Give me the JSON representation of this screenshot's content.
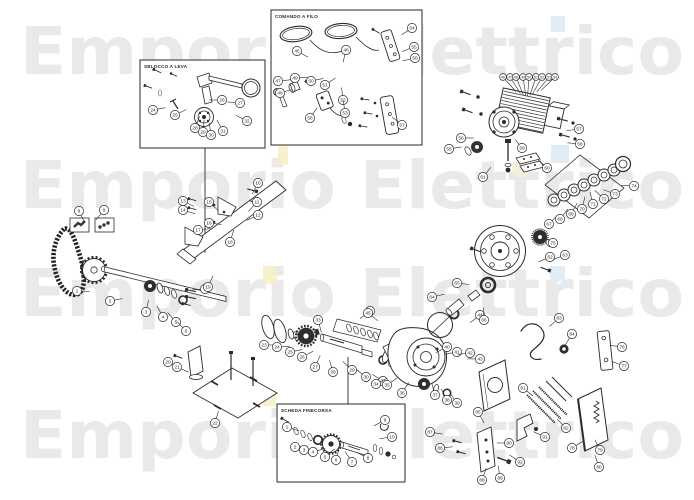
{
  "page": {
    "background": "#ffffff",
    "line_color": "#2a2a2a",
    "dark_fill": "#2e2e2e"
  },
  "watermark": {
    "text": "Emporio Elettrico",
    "color": "#e9e9e9"
  },
  "accents": {
    "yellow": "#f6eec6",
    "blue": "#dceaf5"
  },
  "insets": {
    "sblocco": {
      "label": "SBLOCCO A LEVA"
    },
    "comando": {
      "label": "COMANDO A FILO"
    },
    "scheda": {
      "label": "SCHEDA FINECORSA"
    }
  },
  "callouts": {
    "radius": 4.6,
    "font_size": 4.8,
    "clusters": [
      {
        "name": "chain-shaft",
        "a": [
          150,
          293
        ],
        "items": [
          {
            "n": 1,
            "x": 77,
            "y": 291
          },
          {
            "n": 2,
            "x": 110,
            "y": 301
          },
          {
            "n": 3,
            "x": 146,
            "y": 312
          },
          {
            "n": 4,
            "x": 163,
            "y": 317
          },
          {
            "n": 5,
            "x": 176,
            "y": 322
          },
          {
            "n": 6,
            "x": 186,
            "y": 331
          },
          {
            "n": 7,
            "x": 205,
            "y": 289
          }
        ]
      },
      {
        "name": "fastener-kits",
        "a": [
          88,
          230
        ],
        "items": [
          {
            "n": 8,
            "x": 79,
            "y": 211
          },
          {
            "n": 9,
            "x": 104,
            "y": 210
          }
        ]
      },
      {
        "name": "guide-rail",
        "a": [
          235,
          226
        ],
        "items": [
          {
            "n": 10,
            "x": 258,
            "y": 183
          },
          {
            "n": 11,
            "x": 257,
            "y": 202
          },
          {
            "n": 12,
            "x": 258,
            "y": 215
          },
          {
            "n": 13,
            "x": 183,
            "y": 201
          },
          {
            "n": 14,
            "x": 183,
            "y": 210
          },
          {
            "n": 15,
            "x": 209,
            "y": 202
          },
          {
            "n": 16,
            "x": 209,
            "y": 223
          },
          {
            "n": 17,
            "x": 198,
            "y": 230
          },
          {
            "n": 18,
            "x": 230,
            "y": 242
          },
          {
            "n": 19,
            "x": 208,
            "y": 287
          }
        ]
      },
      {
        "name": "base-plate",
        "a": [
          225,
          388
        ],
        "items": [
          {
            "n": 20,
            "x": 168,
            "y": 362
          },
          {
            "n": 21,
            "x": 177,
            "y": 367
          },
          {
            "n": 22,
            "x": 215,
            "y": 423
          }
        ]
      },
      {
        "name": "output-shaft",
        "a": [
          325,
          345
        ],
        "items": [
          {
            "n": 23,
            "x": 264,
            "y": 345
          },
          {
            "n": 24,
            "x": 277,
            "y": 347
          },
          {
            "n": 25,
            "x": 290,
            "y": 352
          },
          {
            "n": 26,
            "x": 302,
            "y": 357
          },
          {
            "n": 27,
            "x": 315,
            "y": 367
          },
          {
            "n": 28,
            "x": 333,
            "y": 372
          },
          {
            "n": 29,
            "x": 352,
            "y": 370
          },
          {
            "n": 30,
            "x": 366,
            "y": 377
          },
          {
            "n": 31,
            "x": 383,
            "y": 381
          },
          {
            "n": 32,
            "x": 370,
            "y": 311
          },
          {
            "n": 33,
            "x": 318,
            "y": 320
          }
        ]
      },
      {
        "name": "gearbox",
        "a": [
          425,
          358
        ],
        "items": [
          {
            "n": 34,
            "x": 376,
            "y": 384
          },
          {
            "n": 35,
            "x": 387,
            "y": 385
          },
          {
            "n": 36,
            "x": 402,
            "y": 393
          },
          {
            "n": 37,
            "x": 435,
            "y": 395
          },
          {
            "n": 38,
            "x": 447,
            "y": 400
          },
          {
            "n": 39,
            "x": 457,
            "y": 403
          },
          {
            "n": 40,
            "x": 447,
            "y": 347
          },
          {
            "n": 41,
            "x": 457,
            "y": 352
          },
          {
            "n": 42,
            "x": 470,
            "y": 353
          },
          {
            "n": 43,
            "x": 480,
            "y": 359
          },
          {
            "n": 44,
            "x": 480,
            "y": 315
          },
          {
            "n": 45,
            "x": 368,
            "y": 313
          }
        ]
      },
      {
        "name": "motor-row",
        "a": [
          527,
          104
        ],
        "r": 3.4,
        "fs": 3.6,
        "len": 16,
        "items": [
          {
            "n": 46,
            "x": 503,
            "y": 77
          },
          {
            "n": 47,
            "x": 510,
            "y": 77
          },
          {
            "n": 48,
            "x": 516,
            "y": 77
          },
          {
            "n": 49,
            "x": 523,
            "y": 77
          },
          {
            "n": 50,
            "x": 529,
            "y": 77
          },
          {
            "n": 51,
            "x": 536,
            "y": 77
          },
          {
            "n": 52,
            "x": 542,
            "y": 77
          },
          {
            "n": 53,
            "x": 549,
            "y": 77
          },
          {
            "n": 54,
            "x": 555,
            "y": 77
          }
        ]
      },
      {
        "name": "motor-side",
        "a": [
          514,
          138
        ],
        "items": [
          {
            "n": 55,
            "x": 449,
            "y": 149
          },
          {
            "n": 56,
            "x": 461,
            "y": 138
          },
          {
            "n": 57,
            "x": 579,
            "y": 129
          },
          {
            "n": 58,
            "x": 580,
            "y": 144
          },
          {
            "n": 59,
            "x": 522,
            "y": 148
          },
          {
            "n": 60,
            "x": 547,
            "y": 168
          },
          {
            "n": 61,
            "x": 483,
            "y": 177
          }
        ]
      },
      {
        "name": "flange-cone",
        "a": [
          482,
          286
        ],
        "items": [
          {
            "n": 62,
            "x": 550,
            "y": 257
          },
          {
            "n": 63,
            "x": 565,
            "y": 255
          },
          {
            "n": 64,
            "x": 432,
            "y": 297
          },
          {
            "n": 65,
            "x": 457,
            "y": 283
          },
          {
            "n": 66,
            "x": 484,
            "y": 320
          }
        ]
      },
      {
        "name": "bearing-stack",
        "a": [
          588,
          184
        ],
        "items": [
          {
            "n": 67,
            "x": 549,
            "y": 224
          },
          {
            "n": 68,
            "x": 560,
            "y": 219
          },
          {
            "n": 69,
            "x": 571,
            "y": 214
          },
          {
            "n": 70,
            "x": 582,
            "y": 209
          },
          {
            "n": 71,
            "x": 593,
            "y": 204
          },
          {
            "n": 72,
            "x": 604,
            "y": 199
          },
          {
            "n": 73,
            "x": 615,
            "y": 194
          },
          {
            "n": 74,
            "x": 634,
            "y": 186
          },
          {
            "n": 75,
            "x": 553,
            "y": 243,
            "a": [
              542,
              236
            ]
          }
        ]
      },
      {
        "name": "right-panels",
        "a": [
          590,
          398
        ],
        "items": [
          {
            "n": 76,
            "x": 622,
            "y": 347,
            "a": [
              608,
              345
            ]
          },
          {
            "n": 77,
            "x": 624,
            "y": 366,
            "a": [
              608,
              360
            ]
          },
          {
            "n": 78,
            "x": 572,
            "y": 448,
            "a": [
              588,
              438
            ]
          },
          {
            "n": 79,
            "x": 600,
            "y": 450,
            "a": [
              594,
              438
            ]
          },
          {
            "n": 80,
            "x": 599,
            "y": 467,
            "a": [
              593,
              450
            ]
          },
          {
            "n": 81,
            "x": 523,
            "y": 388,
            "a": [
              538,
              400
            ]
          },
          {
            "n": 82,
            "x": 566,
            "y": 428,
            "a": [
              552,
              414
            ]
          },
          {
            "n": 83,
            "x": 559,
            "y": 318,
            "a": [
              540,
              335
            ]
          },
          {
            "n": 84,
            "x": 572,
            "y": 334,
            "a": [
              564,
              347
            ]
          }
        ]
      },
      {
        "name": "lower-brackets",
        "a": [
          495,
          443
        ],
        "items": [
          {
            "n": 85,
            "x": 478,
            "y": 412
          },
          {
            "n": 86,
            "x": 440,
            "y": 448
          },
          {
            "n": 87,
            "x": 430,
            "y": 432
          },
          {
            "n": 88,
            "x": 482,
            "y": 480
          },
          {
            "n": 89,
            "x": 500,
            "y": 478
          },
          {
            "n": 90,
            "x": 509,
            "y": 443
          },
          {
            "n": 91,
            "x": 545,
            "y": 437,
            "a": [
              530,
              430
            ]
          },
          {
            "n": 92,
            "x": 520,
            "y": 462,
            "a": [
              505,
              452
            ]
          }
        ]
      },
      {
        "name": "inset-sblocco",
        "a": [
          206,
          100
        ],
        "items": [
          {
            "n": 24,
            "x": 153,
            "y": 110
          },
          {
            "n": 25,
            "x": 175,
            "y": 115
          },
          {
            "n": 26,
            "x": 222,
            "y": 100
          },
          {
            "n": 27,
            "x": 240,
            "y": 103
          },
          {
            "n": 28,
            "x": 195,
            "y": 128
          },
          {
            "n": 29,
            "x": 203,
            "y": 132
          },
          {
            "n": 30,
            "x": 211,
            "y": 135
          },
          {
            "n": 31,
            "x": 223,
            "y": 131
          },
          {
            "n": 32,
            "x": 247,
            "y": 121
          }
        ]
      },
      {
        "name": "inset-comando",
        "a": [
          340,
          75
        ],
        "items": [
          {
            "n": 45,
            "x": 297,
            "y": 51
          },
          {
            "n": 46,
            "x": 346,
            "y": 50
          },
          {
            "n": 47,
            "x": 278,
            "y": 81
          },
          {
            "n": 48,
            "x": 280,
            "y": 93
          },
          {
            "n": 49,
            "x": 295,
            "y": 78
          },
          {
            "n": 50,
            "x": 311,
            "y": 81
          },
          {
            "n": 51,
            "x": 325,
            "y": 85
          },
          {
            "n": 52,
            "x": 343,
            "y": 100
          },
          {
            "n": 53,
            "x": 345,
            "y": 113
          },
          {
            "n": 54,
            "x": 412,
            "y": 28
          },
          {
            "n": 55,
            "x": 414,
            "y": 47
          },
          {
            "n": 56,
            "x": 415,
            "y": 58
          },
          {
            "n": 57,
            "x": 402,
            "y": 125
          },
          {
            "n": 58,
            "x": 310,
            "y": 118
          }
        ]
      },
      {
        "name": "inset-scheda",
        "a": [
          340,
          444
        ],
        "items": [
          {
            "n": 1,
            "x": 287,
            "y": 427
          },
          {
            "n": 2,
            "x": 295,
            "y": 447
          },
          {
            "n": 3,
            "x": 304,
            "y": 450
          },
          {
            "n": 4,
            "x": 313,
            "y": 452
          },
          {
            "n": 5,
            "x": 325,
            "y": 457
          },
          {
            "n": 6,
            "x": 336,
            "y": 460
          },
          {
            "n": 7,
            "x": 352,
            "y": 462
          },
          {
            "n": 8,
            "x": 368,
            "y": 458
          },
          {
            "n": 9,
            "x": 385,
            "y": 420
          },
          {
            "n": 10,
            "x": 392,
            "y": 437
          }
        ]
      }
    ]
  }
}
